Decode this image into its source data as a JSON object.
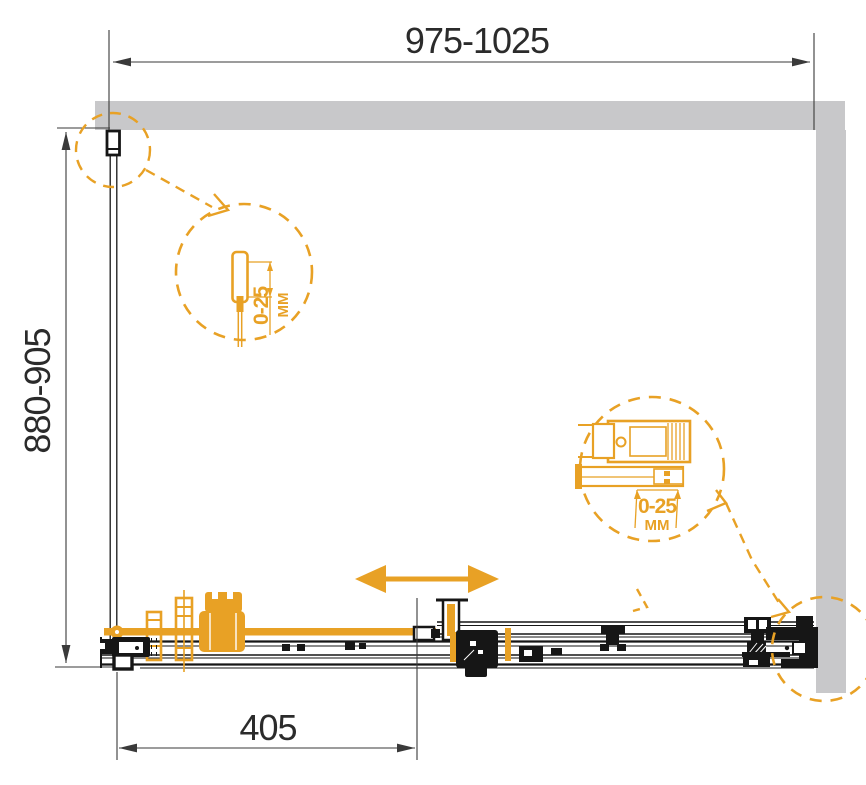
{
  "diagram": {
    "dimensions": {
      "top_width": "975-1025",
      "left_depth": "880-905",
      "bottom_fixed": "405"
    },
    "detail_left": {
      "range": "0-25",
      "unit": "MM"
    },
    "detail_right": {
      "range": "0-25",
      "unit": "MM"
    },
    "colors": {
      "accent_orange": "#E8A125",
      "wall_gray": "#C8C8CA",
      "line_black": "#161616",
      "dimension_gray": "#3a3a3a"
    }
  }
}
